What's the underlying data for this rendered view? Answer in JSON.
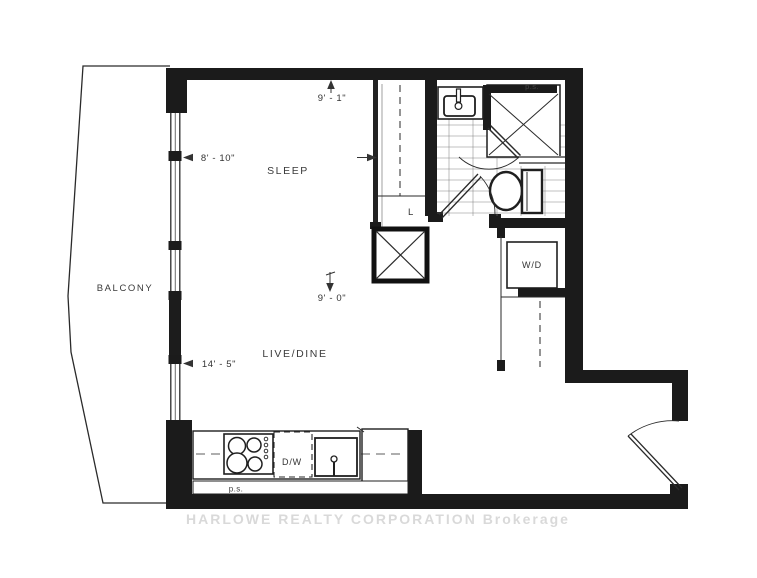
{
  "labels": {
    "balcony": "BALCONY",
    "sleep": "SLEEP",
    "live_dine": "LIVE/DINE",
    "linen_closet": "L",
    "washer_dryer": "W/D",
    "dishwasher": "D/W",
    "pipe_shaft_top": "p.s.",
    "pipe_shaft_bottom": "p.s."
  },
  "dimensions": {
    "sleep_top": "9' - 1\"",
    "sleep_width": "8' - 10\"",
    "live_height": "9' - 0\"",
    "live_width": "14' - 5\""
  },
  "watermark": "HARLOWE REALTY CORPORATION  Brokerage",
  "colors": {
    "wall": "#1b1b1b",
    "line": "#2a2a2a",
    "watermark_gray": "#bdbdbd"
  }
}
